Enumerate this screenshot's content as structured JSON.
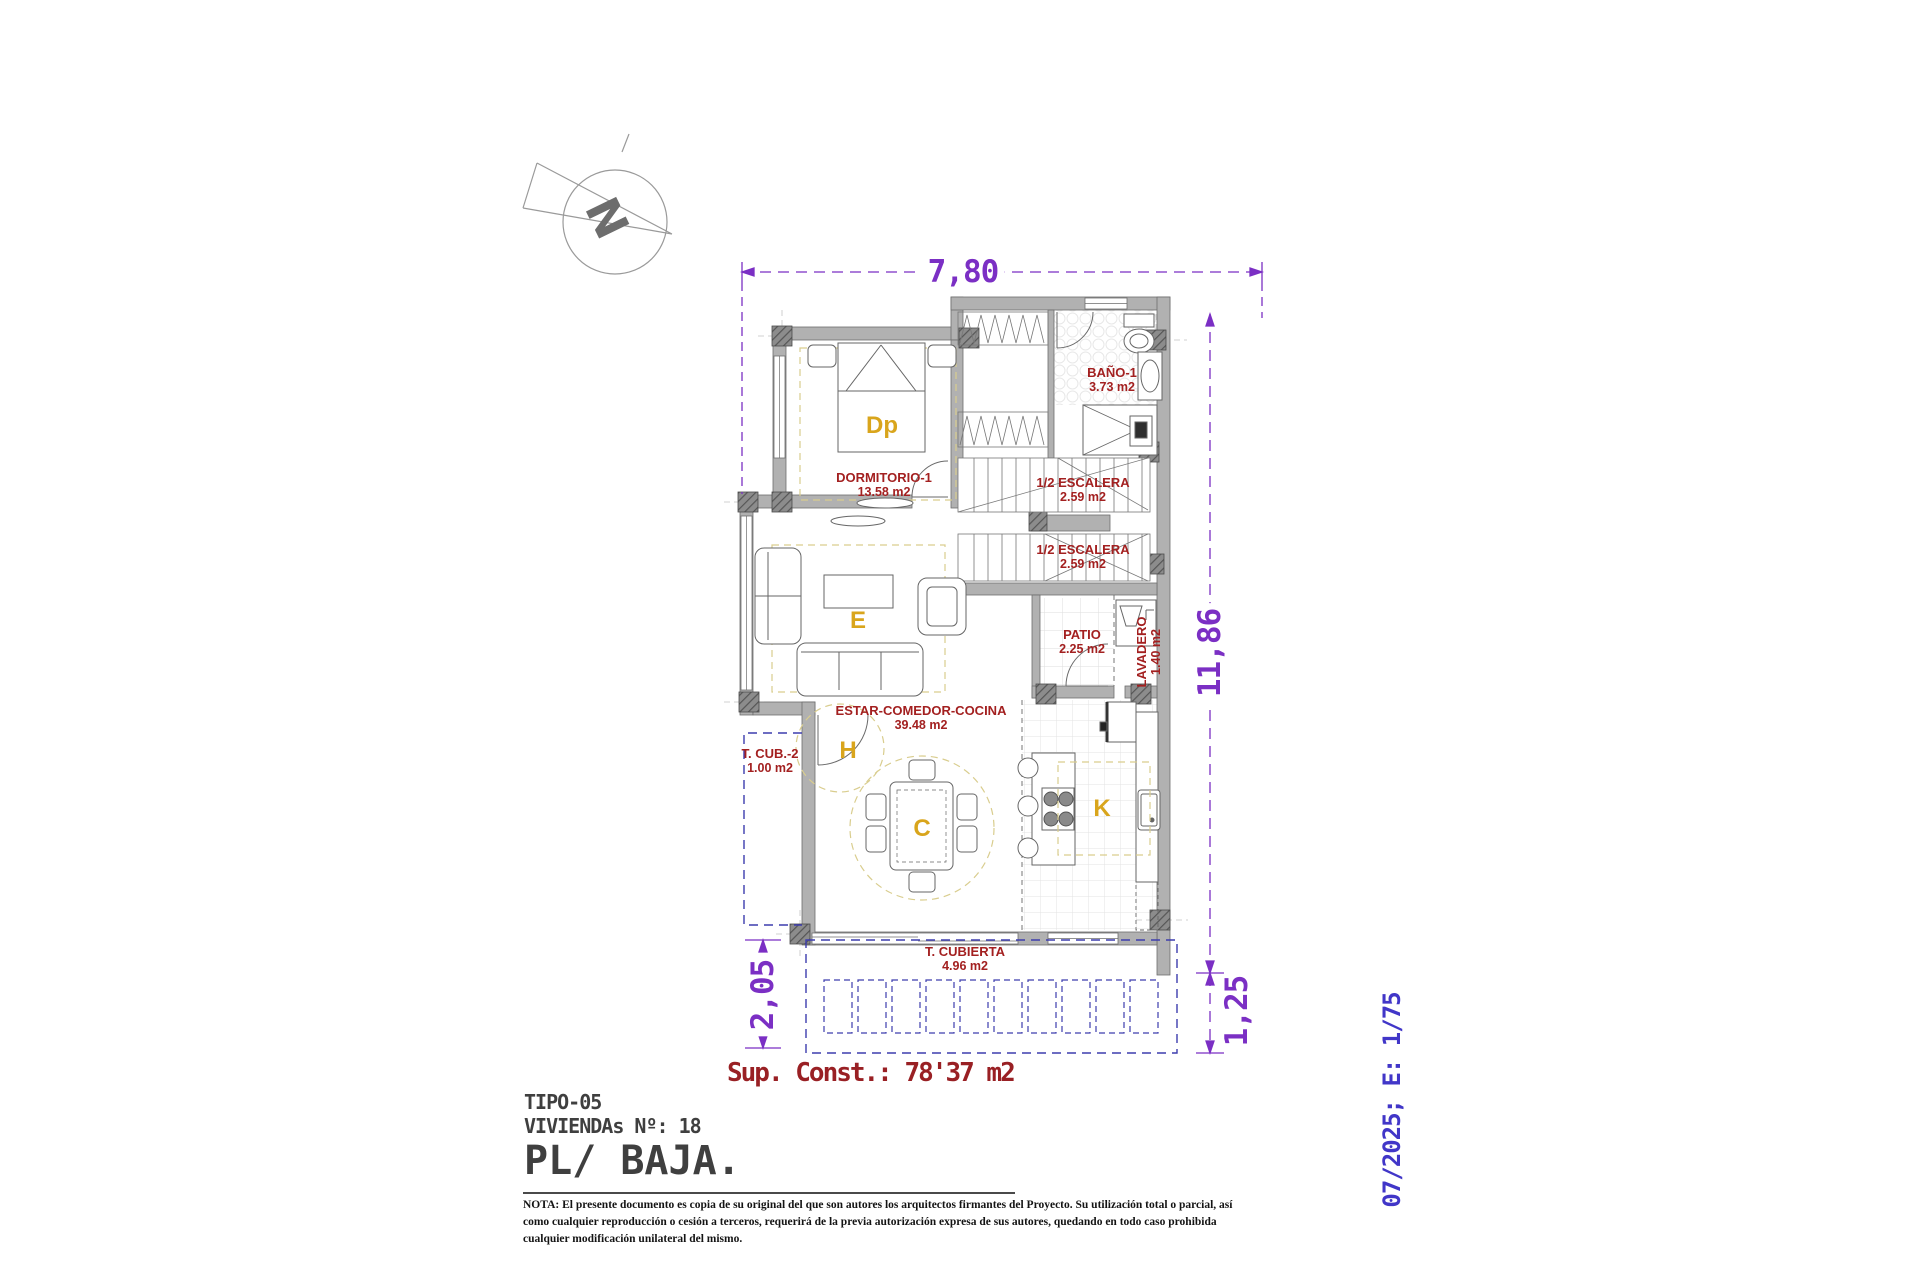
{
  "colors": {
    "dimension_purple": "#7b2fc4",
    "scale_note_blue": "#4136c8",
    "room_label_red": "#a32020",
    "area_summary_red": "#992024",
    "room_letter_gold": "#d9a51c",
    "wall_gray": "#b1b1b1",
    "terrace_dash_blue": "#3d3dae",
    "zone_dash_yellow": "#d9cd8e",
    "title_gray": "#3f3f3f"
  },
  "compass": {
    "label": "N"
  },
  "dimensions": {
    "top_width": "7,80",
    "right_height": "11,86",
    "left_terrace_depth": "2,05",
    "right_terrace_depth": "1,25"
  },
  "rooms": {
    "dormitorio": {
      "name": "DORMITORIO-1",
      "area": "13.58 m2",
      "letter": "Dp"
    },
    "bano": {
      "name": "BAÑO-1",
      "area": "3.73 m2"
    },
    "escalera_superior": {
      "name": "1/2 ESCALERA",
      "area": "2.59 m2"
    },
    "escalera_inferior": {
      "name": "1/2 ESCALERA",
      "area": "2.59 m2"
    },
    "patio": {
      "name": "PATIO",
      "area": "2.25 m2"
    },
    "lavadero": {
      "name": "LAVADERO",
      "area": "1.40 m2"
    },
    "estar": {
      "name": "ESTAR-COMEDOR-COCINA",
      "area": "39.48 m2",
      "letter_estar": "E",
      "letter_hall": "H",
      "letter_comedor": "C",
      "letter_cocina": "K"
    },
    "terraza_cubierta_2": {
      "name": "T. CUB.-2",
      "area": "1.00 m2"
    },
    "terraza_cubierta": {
      "name": "T. CUBIERTA",
      "area": "4.96 m2"
    }
  },
  "summary": {
    "built_area": "Sup. Const.: 78'37 m2"
  },
  "title_block": {
    "tipo": "TIPO-05",
    "viviendas": "VIVIENDAs Nº: 18",
    "planta": "PL/ BAJA."
  },
  "side_note": {
    "date_scale": "07/2025; E: 1/75"
  },
  "nota": {
    "line1": "NOTA: El presente documento es copia de su original del que son autores los arquitectos firmantes del Proyecto. Su utilización total o parcial, así",
    "line2": "como cualquier reproducción o cesión a terceros, requerirá  de la previa autorización expresa de sus autores, quedando en todo caso prohibida",
    "line3": "cualquier modificación unilateral del mismo."
  }
}
